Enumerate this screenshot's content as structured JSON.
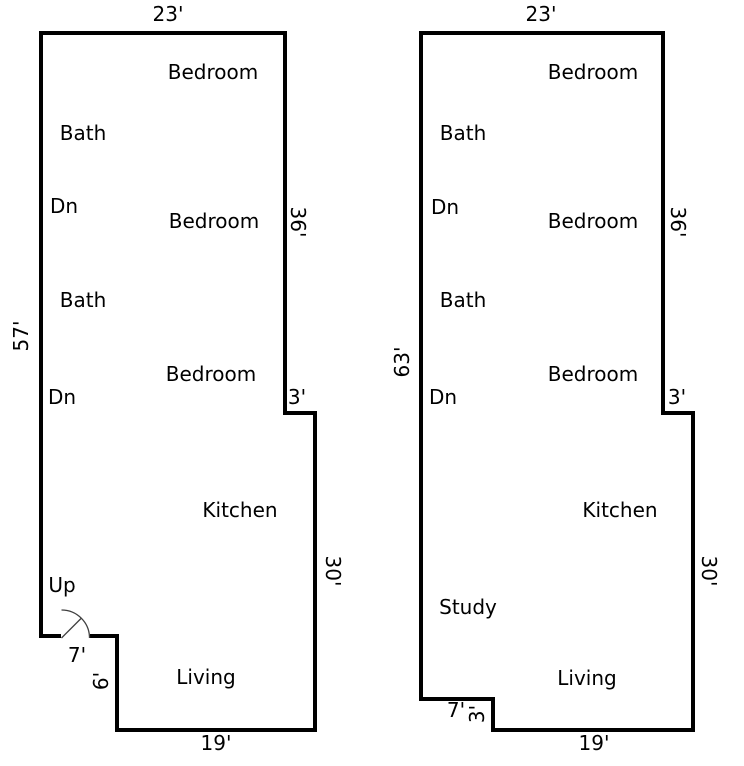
{
  "colors": {
    "background": "#ffffff",
    "wall": "#000000",
    "door_line": "#3f3f3f",
    "text": "#000000"
  },
  "plans": [
    {
      "title": "left floor plan",
      "outline_path": "M 90 636 L 117 636 L 117 730 L 315 730 L 315 413 L 285 413 L 285 33 L 41 33 L 41 636 L 61 636",
      "door": {
        "arc_path": "M 61.5 610 A 28 28 0 0 1 89.5 638",
        "leaf_path": "M 61.5 638 L 81.5 618"
      },
      "rooms": [
        {
          "label": "Bedroom"
        },
        {
          "label": "Bath"
        },
        {
          "label": "Dn"
        },
        {
          "label": "Bedroom"
        },
        {
          "label": "Bath"
        },
        {
          "label": "Bedroom"
        },
        {
          "label": "Dn"
        },
        {
          "label": "Kitchen"
        },
        {
          "label": "Up"
        },
        {
          "label": "Living"
        }
      ],
      "dimensions": [
        {
          "value": "23'",
          "edge": "top"
        },
        {
          "value": "36'",
          "edge": "right-upper"
        },
        {
          "value": "57'",
          "edge": "left"
        },
        {
          "value": "3'",
          "edge": "right-step"
        },
        {
          "value": "30'",
          "edge": "right-lower"
        },
        {
          "value": "7'",
          "edge": "bottom-left-step"
        },
        {
          "value": "6'",
          "edge": "bottom-left-step-side"
        },
        {
          "value": "19'",
          "edge": "bottom"
        }
      ]
    },
    {
      "title": "right floor plan",
      "outline_path": "M 421 33 L 663 33 L 663 413 L 693 413 L 693 730 L 493 730 L 493 699 L 421 699 Z",
      "rooms": [
        {
          "label": "Bedroom"
        },
        {
          "label": "Bath"
        },
        {
          "label": "Dn"
        },
        {
          "label": "Bedroom"
        },
        {
          "label": "Bath"
        },
        {
          "label": "Bedroom"
        },
        {
          "label": "Dn"
        },
        {
          "label": "Kitchen"
        },
        {
          "label": "Study"
        },
        {
          "label": "Living"
        }
      ],
      "dimensions": [
        {
          "value": "23'",
          "edge": "top"
        },
        {
          "value": "36'",
          "edge": "right-upper"
        },
        {
          "value": "63'",
          "edge": "left"
        },
        {
          "value": "3'",
          "edge": "right-step"
        },
        {
          "value": "30'",
          "edge": "right-lower"
        },
        {
          "value": "7'",
          "edge": "bottom-left-step"
        },
        {
          "value": "3'",
          "edge": "bottom-left-step-side"
        },
        {
          "value": "19'",
          "edge": "bottom"
        }
      ]
    }
  ]
}
